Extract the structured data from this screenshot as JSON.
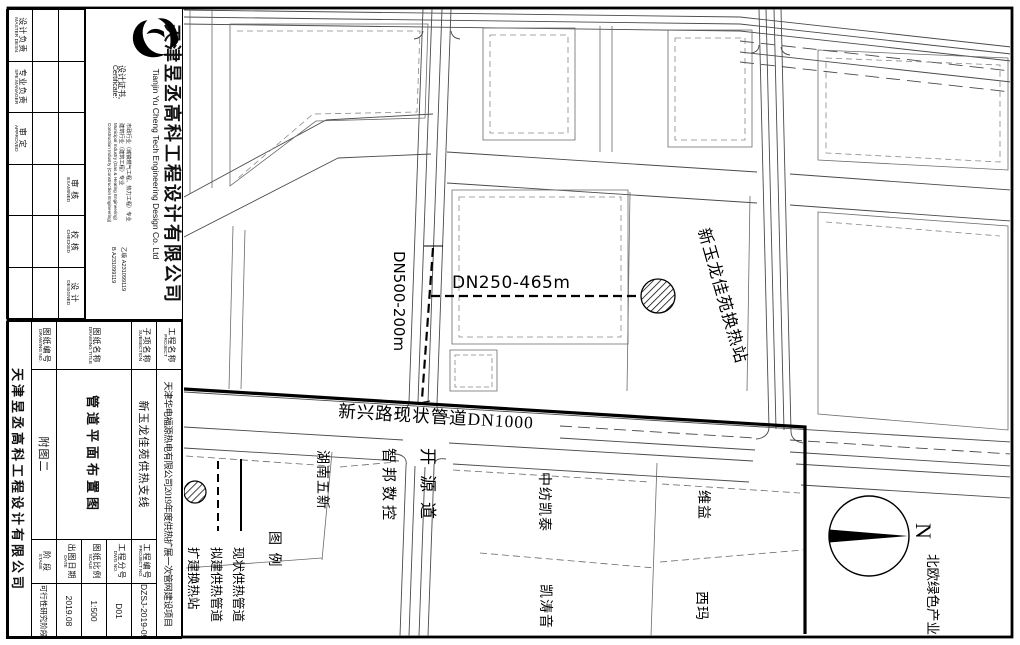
{
  "colors": {
    "ink": "#111111",
    "line": "#4a4a4a",
    "parcel": "#6a6a6a"
  },
  "sheet": {
    "company": {
      "logo_icon": "yucheng-monogram",
      "name_cn": "天津昱丞高科工程设计有限公司",
      "name_en": "Tianjin Yu Cheng Tech Engineering Design Co. Ltd",
      "cert_label_cn": "设计证书,",
      "cert_label_en": "Certificate:",
      "cert_line1": "市政行业（城镇燃气工程、热力工程）专业",
      "cert_line2": "建筑行业（建筑工程）专业",
      "cert_line3": "Municipal Industry (Gas & Heating Engineering)",
      "cert_line4": "Construction Industry (Construction Engineering)",
      "grade1": "乙级  A231099119",
      "grade2": "B  A231099119"
    },
    "personnel": {
      "c1": "设计负责",
      "c1en": "MASTER DESN.",
      "c2": "专业负责",
      "c2en": "SPE.MANAGER",
      "c3": "审  定",
      "c3en": "APPROVED",
      "c4": "审  核",
      "c4en": "EXAMINED",
      "c5": "校  核",
      "c5en": "CHECKED",
      "c6": "设  计",
      "c6en": "DESIGNED"
    },
    "project": {
      "name_label": "工程名称",
      "name_en": "PROJECT",
      "name_value": "天津华电福源热电有限公司2019年度供热扩展一次管网建设项目",
      "sub_label": "子项名称",
      "sub_en": "SUBSECTION",
      "sub_value": "新玉龙佳苑供热支线",
      "title_label": "图纸名称",
      "title_en": "DRAWING TITLE",
      "title_value": "管道平面布置图",
      "dno_label": "图纸编号",
      "dno_en": "DRAWING NO.",
      "dno_value": "附图二",
      "pno_label": "工程编号",
      "pno_en": "PROJECT NO.",
      "pno_value": "DZSJ-2019-094",
      "dwg_label": "工程分号",
      "dwg_en": "DWG NO.",
      "dwg_value": "D01",
      "scale_label": "图纸比例",
      "scale_en": "SCALE",
      "scale_value": "1:500",
      "date_label": "出图日期",
      "date_en": "DATE",
      "date_value": "2019.08",
      "stage_label": "阶  段",
      "stage_en": "STAGE",
      "stage_value": "可行性研究阶段",
      "company_name": "天津昱丞高科工程设计有限公司"
    }
  },
  "map": {
    "labels": {
      "main_pipe": "新兴路现状管道DN1000",
      "branch_pipe": "DN250-465m",
      "riser_pipe": "DN500-200m",
      "station": "新玉龙佳苑换热站",
      "road": "开源道",
      "parcel_zhibang": "智邦数控",
      "parcel_hunan": "湖南五新",
      "parcel_zhongfang": "中纺凯泰",
      "parcel_weiyi": "维益",
      "parcel_kaitao": "凯涛音",
      "parcel_xima": "西玛",
      "parcel_beiou": "北欧绿色产业",
      "north": "N"
    },
    "legend": {
      "title": "图  例",
      "existing": "现状供热管道",
      "planned": "拟建供热管道",
      "station": "扩建换热站"
    }
  }
}
